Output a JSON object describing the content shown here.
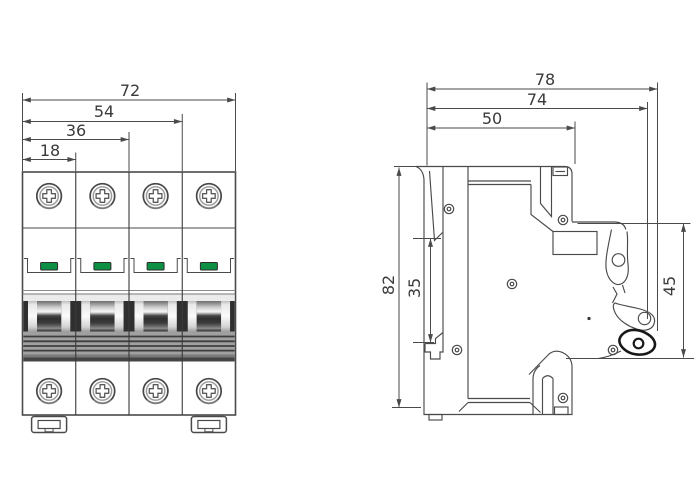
{
  "colors": {
    "line": "#4a4a4a",
    "text": "#3a3a3a",
    "indicator_green": "#0e9044"
  },
  "drawing": {
    "front_view": {
      "poles": 4,
      "dims": {
        "total_width": "72",
        "three_pole_width": "54",
        "two_pole_width": "36",
        "one_pole_width": "18"
      }
    },
    "side_view": {
      "dims": {
        "depth_overall": "78",
        "depth_to_lever_pivot": "74",
        "depth_body": "50",
        "height_overall": "82",
        "din_rail_slot": "35",
        "front_section_height": "45"
      }
    }
  }
}
